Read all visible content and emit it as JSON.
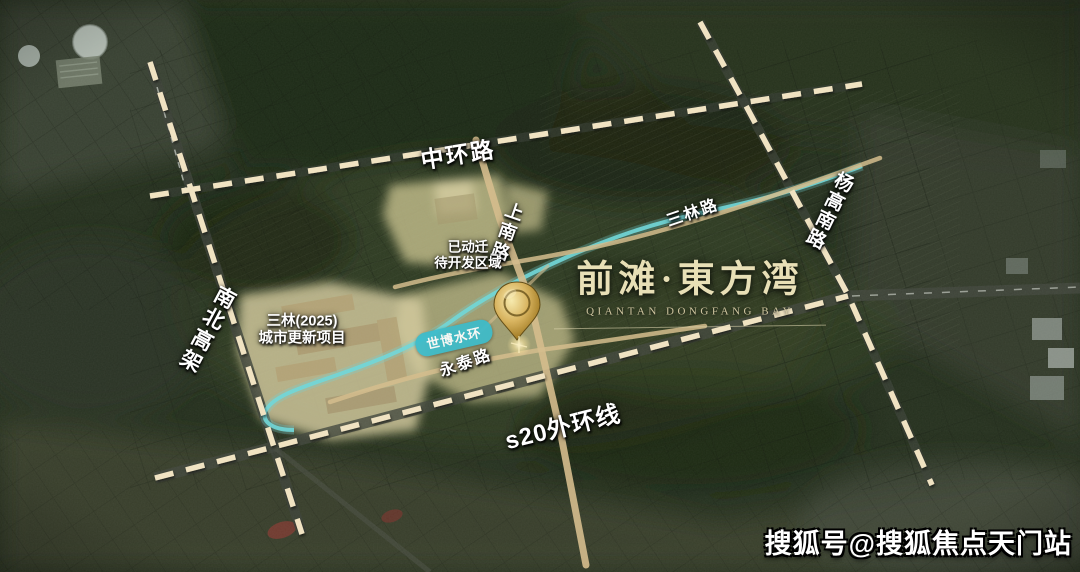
{
  "map": {
    "title": {
      "cn": "前滩·東方湾",
      "en": "QIANTAN DONGFANG BAY"
    },
    "roads": {
      "zhonghuan": "中环路",
      "shangnan": "上南路",
      "sanlin": "三林路",
      "yanggao": "杨高南路",
      "nanbei": "南北高架",
      "s20": "s20外环线",
      "yongtai": "永泰路"
    },
    "areas": {
      "redevelopment_line1": "已动迁",
      "redevelopment_line2": "待开发区域",
      "sanlin2025_line1": "三林(2025)",
      "sanlin2025_line2": "城市更新项目",
      "shibo_ring": "世博水环"
    },
    "watermark": "搜狐号@搜狐焦点天门站"
  },
  "colors": {
    "dash": "#f2e4c3",
    "river": "#6fd8da",
    "road": "#d6bd8c",
    "parcel": "#c6bf8c",
    "parcel_light": "#d4cb9e",
    "marker_gold": "#c99d3f",
    "title": "#e8dfb6",
    "label": "#ffffff",
    "shibo_badge": "#3cbccb"
  }
}
